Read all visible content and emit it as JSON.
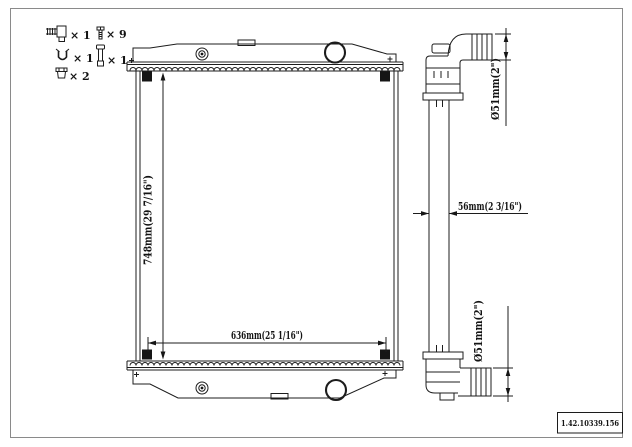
{
  "page": {
    "background": "#ffffff",
    "line_color": "#1c1c1c",
    "part_number": "1.42.10339.156"
  },
  "legend": {
    "items": [
      {
        "name": "drain-cock",
        "qty": "× 1"
      },
      {
        "name": "screw",
        "qty": "× 9"
      },
      {
        "name": "clip",
        "qty": "× 1"
      },
      {
        "name": "pin",
        "qty": "× 1"
      },
      {
        "name": "cap",
        "qty": "× 2"
      }
    ]
  },
  "dimensions": {
    "overall_height": "748mm(29 7/16\")",
    "core_width": "636mm(25 1/16\")",
    "core_depth": "56mm(2 3/16\")",
    "inlet_diameter": "Ø51mm(2\")",
    "outlet_diameter": "Ø51mm(2\")"
  }
}
